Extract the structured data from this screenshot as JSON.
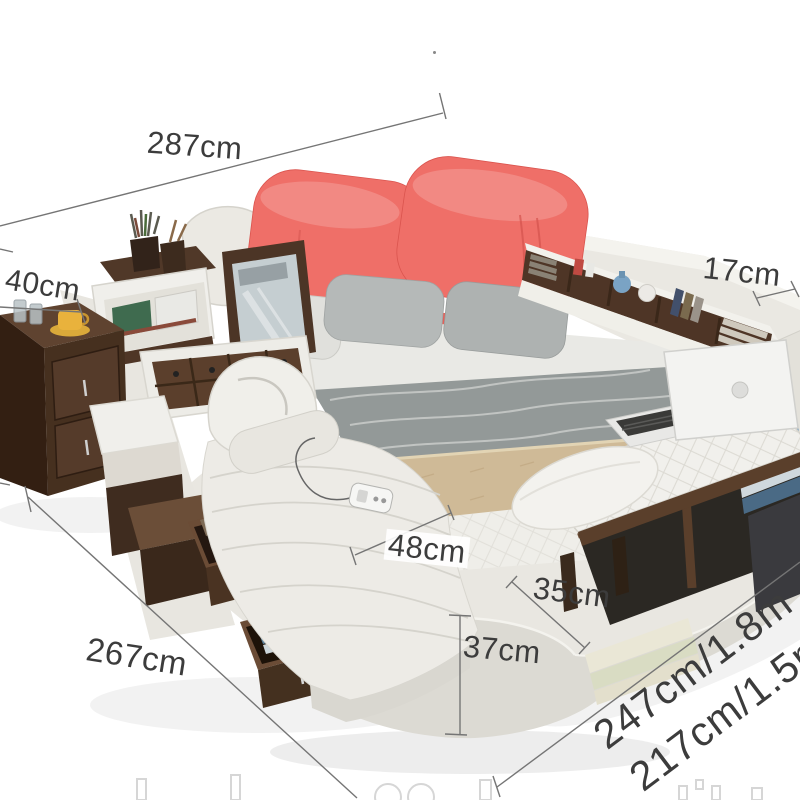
{
  "annotations": {
    "bed_total_width": {
      "label": "287cm"
    },
    "nightstand_depth": {
      "label": "40cm"
    },
    "headboard_shelf_depth": {
      "label": "17cm"
    },
    "chaise_width": {
      "label": "48cm"
    },
    "corner_depth": {
      "label": "35cm"
    },
    "platform_height": {
      "label": "37cm"
    },
    "bed_side_length": {
      "label": "267cm"
    },
    "mattress_option_large": {
      "label": "247cm/1.8m"
    },
    "mattress_option_small": {
      "label": "217cm/1.5m"
    }
  },
  "colors": {
    "coral": "#ef6f68",
    "coral_dark": "#e0564f",
    "leather_white": "#eae8e2",
    "leather_shadow": "#d8d6cf",
    "wood_dark": "#46301f",
    "wood_mid": "#5f4330",
    "bedding_gray": "#b5b9b8",
    "blanket_gray": "#939998",
    "runner_beige": "#cfba97",
    "clothes_blue": "#7fa3bd",
    "cup_yellow": "#e9b23c",
    "vase_blue": "#7aa3c4",
    "dim_line": "#757575",
    "dim_text": "#3c3c3c"
  }
}
